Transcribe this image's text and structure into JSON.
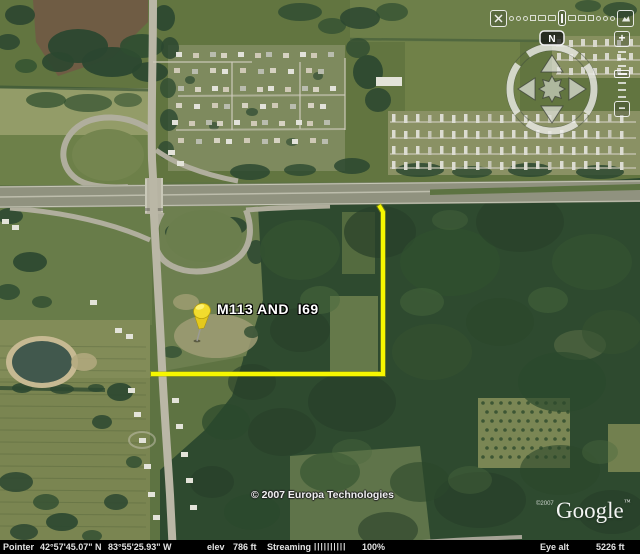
{
  "map": {
    "placemark": {
      "label": "M113 AND  I69",
      "pin_color": "#f2dc2e"
    },
    "measure_path": {
      "color": "#f6f600"
    },
    "attribution": {
      "imagery": "© 2007 Europa Technologies"
    },
    "branding": {
      "logo": "Google",
      "trademark": "™",
      "watermark": "©2007"
    }
  },
  "navigation": {
    "compass": {
      "north_label": "N"
    },
    "zoom_slider": {
      "zoom_in_label": "+",
      "zoom_out_label": "−"
    }
  },
  "status_bar": {
    "pointer_label": "Pointer",
    "latitude": "42°57'45.07\" N",
    "longitude": "83°55'25.93\" W",
    "elevation_label": "elev",
    "elevation_value": "786 ft",
    "streaming_label": "Streaming",
    "streaming_bars": "||||||||||",
    "streaming_percent": "100%",
    "eye_alt_label": "Eye alt",
    "eye_alt_value": "5226 ft"
  }
}
